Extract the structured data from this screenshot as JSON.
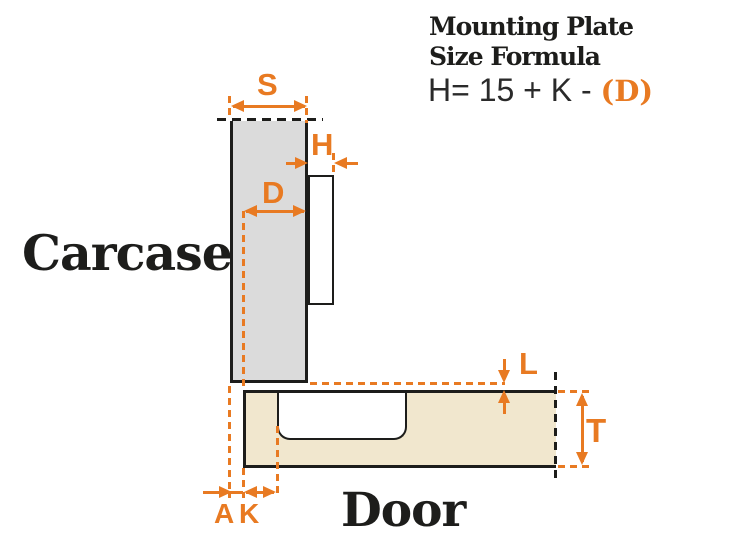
{
  "header": {
    "title_line1": "Mounting Plate",
    "title_line2": "Size Formula",
    "formula": {
      "prefix": "H= 15 + K - ",
      "highlight": "(D)"
    }
  },
  "diagram": {
    "carcase_label": "Carcase",
    "door_label": "Door",
    "dimensions": {
      "s": "S",
      "h": "H",
      "d": "D",
      "l": "L",
      "t": "T",
      "a": "A",
      "k": "K"
    },
    "colors": {
      "accent": "#E87A22",
      "carcase_fill": "#DBDBDB",
      "door_fill": "#F1E7CE",
      "outline": "#1D1D1B"
    }
  }
}
